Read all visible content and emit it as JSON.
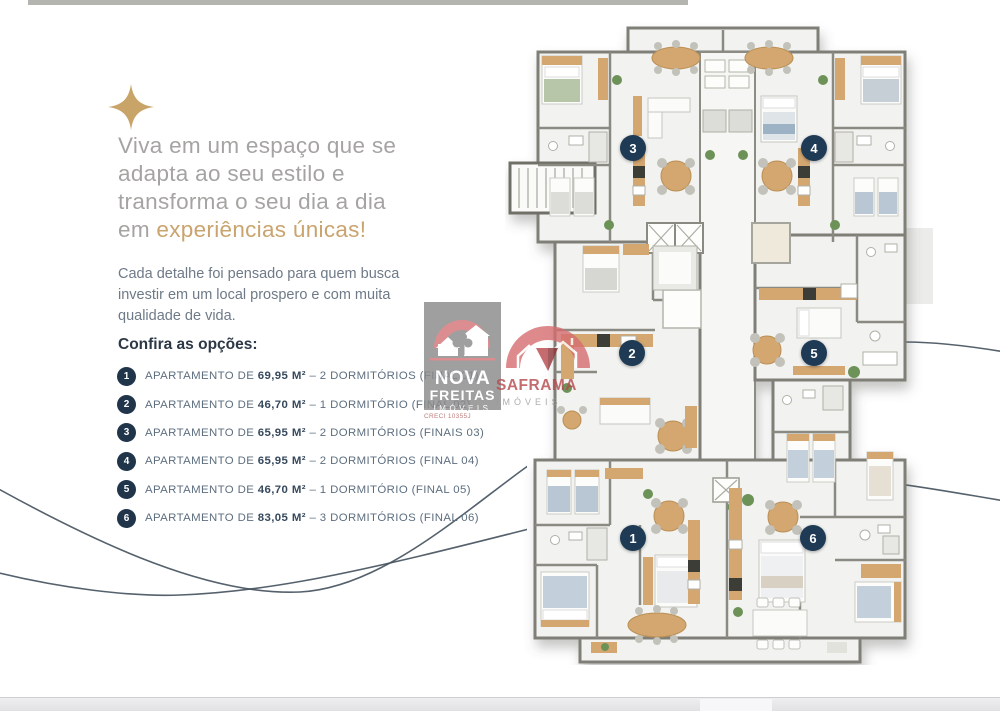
{
  "hero": {
    "line1": "Viva em um espaço que se",
    "line2": "adapta ao seu estilo e",
    "line3": "transforma o seu dia a dia",
    "line4_prefix": "em ",
    "line4_highlight": "experiências únicas!",
    "text_color": "#a5a4a2",
    "highlight_color": "#c9a46e"
  },
  "intro": {
    "line1": "Cada detalhe foi pensado para quem busca",
    "line2": "investir em um local prospero e com muita",
    "line3": "qualidade de vida."
  },
  "options": {
    "heading": "Confira as opções:",
    "items": [
      {
        "number": "1",
        "prefix": "APARTAMENTO DE ",
        "area": "69,95 M²",
        "suffix": " – 2 DORMITÓRIOS (FINAL 01)"
      },
      {
        "number": "2",
        "prefix": "APARTAMENTO DE ",
        "area": "46,70 M²",
        "suffix": " – 1 DORMITÓRIO (FINAL 02)"
      },
      {
        "number": "3",
        "prefix": "APARTAMENTO DE ",
        "area": "65,95 M²",
        "suffix": " – 2 DORMITÓRIOS (FINAIS 03)"
      },
      {
        "number": "4",
        "prefix": "APARTAMENTO DE ",
        "area": "65,95 M²",
        "suffix": " – 2 DORMITÓRIOS (FINAL 04)"
      },
      {
        "number": "5",
        "prefix": "APARTAMENTO DE ",
        "area": "46,70 M²",
        "suffix": " – 1 DORMITÓRIO (FINAL 05)"
      },
      {
        "number": "6",
        "prefix": "APARTAMENTO DE ",
        "area": "83,05 M²",
        "suffix": " – 3 DORMITÓRIOS (FINAL 06)"
      }
    ]
  },
  "floorplan": {
    "units": [
      {
        "number": "1"
      },
      {
        "number": "2"
      },
      {
        "number": "3"
      },
      {
        "number": "4"
      },
      {
        "number": "5"
      },
      {
        "number": "6"
      }
    ],
    "badge_color": "#1e3a54"
  },
  "watermarks": {
    "nova": {
      "line1": "NOVA",
      "line2": "FREITAS",
      "line3": "IMÓVEIS",
      "creci": "CRECI 10355J"
    },
    "saframa": {
      "name": "SAFRAMA",
      "subtitle": "IMÓVEIS"
    }
  },
  "decor": {
    "star_color": "#c9a469",
    "curve_color": "#43505c",
    "navy": "#20344a",
    "wall_color": "#7f7f77",
    "furniture_tan": "#d4a76f"
  }
}
